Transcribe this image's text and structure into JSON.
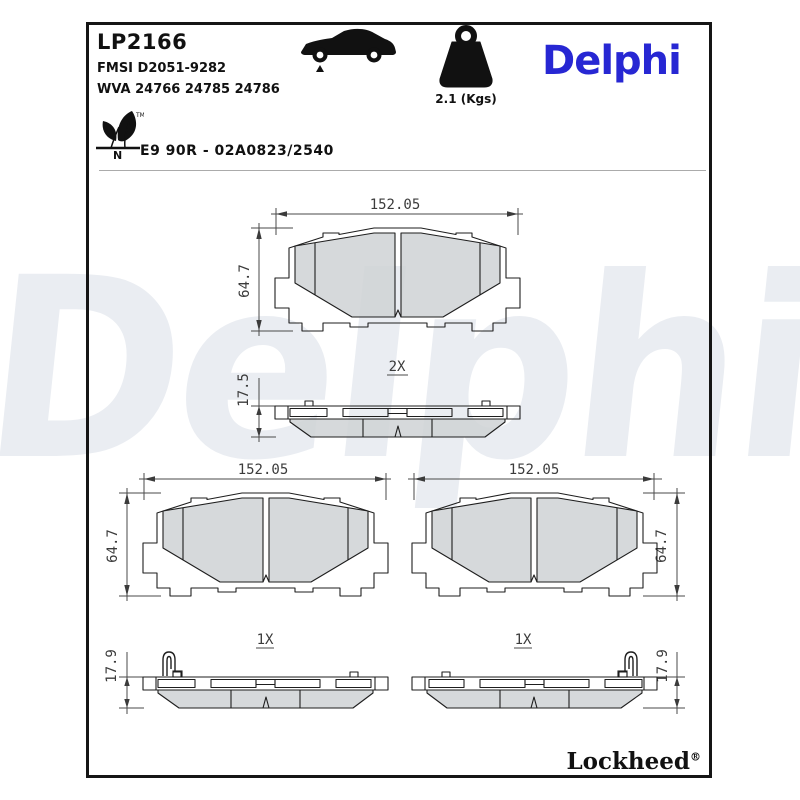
{
  "header": {
    "part_number": "LP2166",
    "fmsi": "FMSI D2051-9282",
    "wva": "WVA 24766 24785 24786",
    "weight": "2.1 (Kgs)",
    "brand": "Delphi",
    "approval": "E9 90R - 02A0823/2540",
    "leaf_tm": "TM",
    "leaf_n": "N"
  },
  "drawings": {
    "front_pair": {
      "width": "152.05",
      "height": "64.7",
      "qty": "2X",
      "thickness": "17.5"
    },
    "front_left": {
      "width": "152.05",
      "height": "64.7",
      "qty": "1X",
      "thickness": "17.9"
    },
    "front_right": {
      "width": "152.05",
      "height": "64.7",
      "qty": "1X",
      "thickness": "17.9"
    }
  },
  "watermark": "Delphi",
  "footer": {
    "brand": "Lockheed",
    "registered": "®"
  },
  "colors": {
    "brand_blue": "#2727d3",
    "watermark": "#eaedf2",
    "friction_gray": "#cfd2d5"
  }
}
